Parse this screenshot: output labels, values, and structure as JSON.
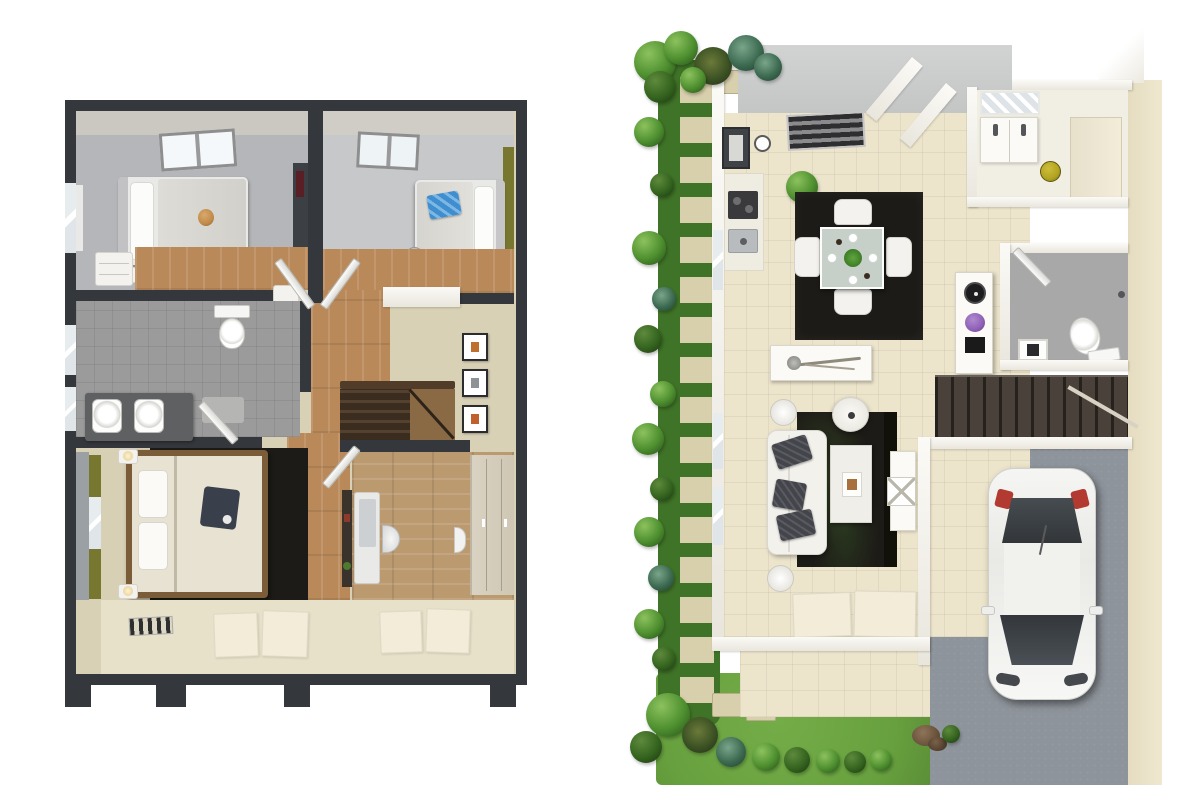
{
  "scene": {
    "description": "Two 3D top-down architectural floor plan renders side by side on a white background",
    "left_plan_title": "Upper floor 3D plan",
    "right_plan_title": "Ground floor 3D plan with garden and garage"
  },
  "plans": {
    "upper_floor": {
      "title": "Upper floor 3D plan",
      "rooms": [
        "bedroom-left",
        "bedroom-right",
        "bathroom",
        "hallway",
        "stairwell",
        "master-bedroom",
        "study"
      ],
      "furniture": [
        "single-bed",
        "teddy-bear",
        "single-bed-blue-blanket",
        "desk-chair",
        "toilet",
        "double-sink-vanity",
        "staircase",
        "picture-frames",
        "double-bed",
        "nightstand-lamps",
        "study-desk",
        "wardrobe"
      ]
    },
    "ground_floor": {
      "title": "Ground floor 3D plan",
      "zones": [
        "garden-path",
        "stepping-stones",
        "dining-area",
        "kitchenette",
        "bathroom",
        "wc",
        "hallway",
        "living-area",
        "staircase",
        "garage",
        "driveway",
        "patio",
        "lawn"
      ],
      "furniture": [
        "dining-table",
        "dining-chairs",
        "area-rug",
        "console-table",
        "display-pedestal",
        "purple-flowers",
        "sofa",
        "coffee-table",
        "floor-lamp",
        "toilet",
        "vanity",
        "white-car"
      ]
    }
  },
  "palette": {
    "wall_dark": "#34373c",
    "wall_face": "#9aa0a4",
    "wood_floor": "#b9895a",
    "wood_floor_light": "#bb9a70",
    "carpet_beige": "#d9d1b6",
    "carpet_beige_light": "#e8e1c9",
    "room_gray": "#b4b6b9",
    "room_gray_light": "#c6c8c9",
    "bath_gray": "#9b9b9b",
    "accent_olive": "#77772f",
    "white_furniture": "#f3f2ee",
    "rug_dark": "#1d1b17",
    "cream_floor": "#ece4cb",
    "roof_gray": "#d2d3d3",
    "stone_beige": "#d8cfac",
    "garden_green_dark": "#3f7327",
    "lawn_green": "#67a03e",
    "concrete_gray": "#8e949b",
    "beige_wall": "#e5dcc0",
    "mat_light": "#f2ecd8",
    "stairs_brown": "#4a423a",
    "blue_blanket": "#3e8ed0",
    "purple_flower": "#8e5fb5",
    "yellow_item": "#b1a421",
    "red_taillight": "#b23a30",
    "teddy_orange": "#c08a4a"
  }
}
